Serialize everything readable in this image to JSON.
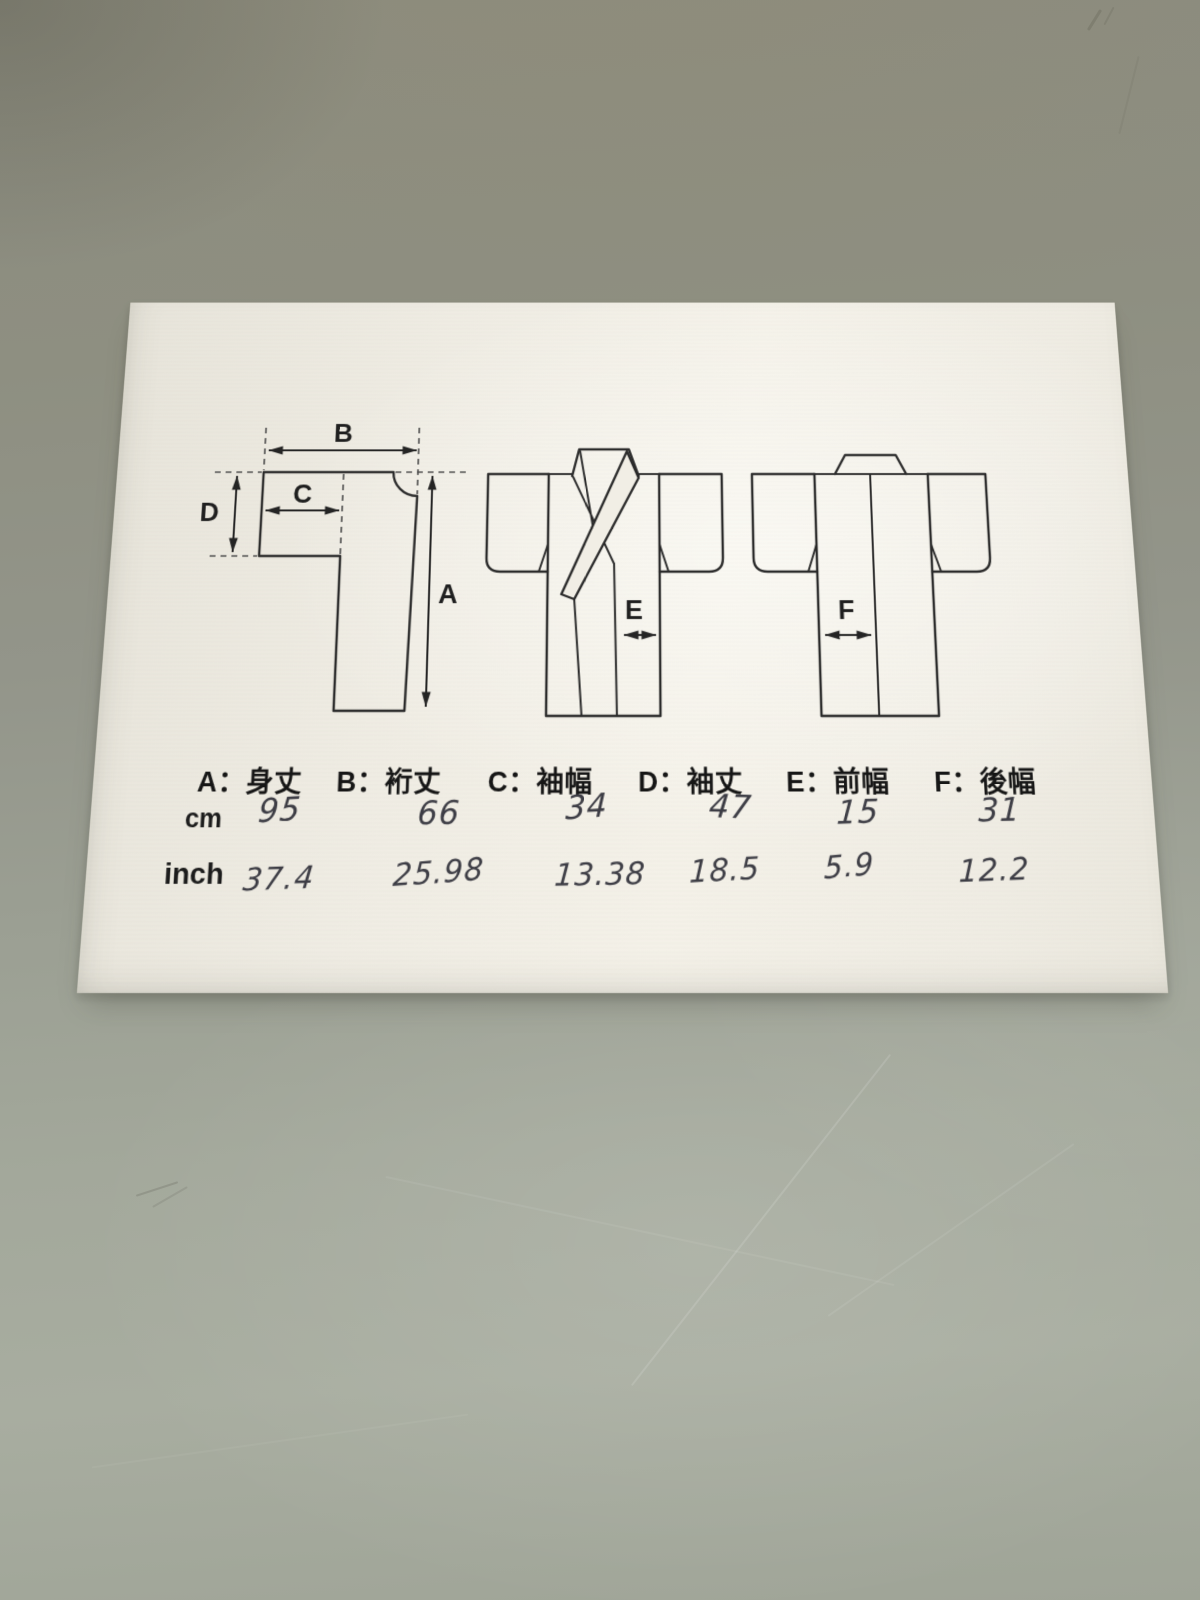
{
  "photo": {
    "subject": "kimono measurement chart sheet on table"
  },
  "legend": {
    "items": [
      "A：身丈",
      "B：裄丈",
      "C：袖幅",
      "D：袖丈",
      "E：前幅",
      "F：後幅"
    ]
  },
  "table": {
    "rows": [
      {
        "label": "cm",
        "values": [
          "95",
          "66",
          "34",
          "47",
          "15",
          "31"
        ]
      },
      {
        "label": "inch",
        "values": [
          "37.4",
          "25.98",
          "13.38",
          "18.5",
          "5.9",
          "12.2"
        ]
      }
    ]
  },
  "arrows": {
    "flat": {
      "a": "A",
      "b": "B",
      "c": "C",
      "d": "D"
    },
    "front": {
      "e": "E"
    },
    "back": {
      "f": "F"
    }
  },
  "colors": {
    "table_surface": "#9b9f93",
    "paper": "#f1eee5",
    "ink": "#2b2b2b",
    "handwriting": "#3d3d45"
  }
}
